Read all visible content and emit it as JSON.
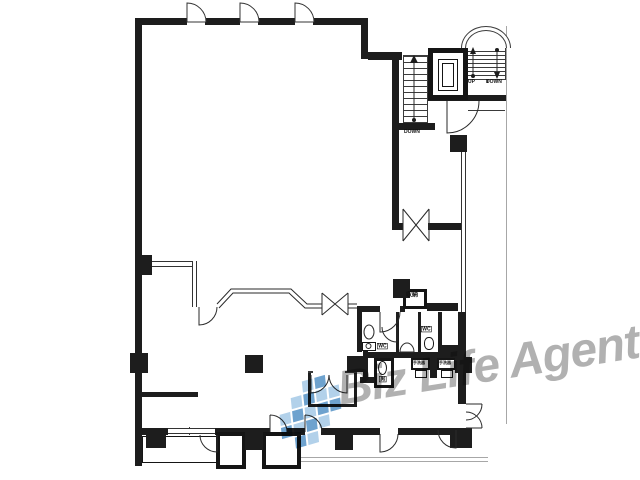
{
  "meta": {
    "background": "#ffffff",
    "wall_color": "#1d1d1d",
    "line_color": "#3a3a3a",
    "boundary_color": "#a7a7a7"
  },
  "watermark": {
    "text": "Biz Life Agent",
    "color": "#9b9b9b",
    "opacity": 0.78,
    "rotation_deg": -9,
    "font_px": 48,
    "x": 338,
    "y": 362,
    "logo": {
      "x": 279,
      "y": 380,
      "tile": 13,
      "rotation_deg": -16,
      "skew_deg": -10,
      "colors": [
        "",
        "#a5c9e6",
        "#5592c6"
      ],
      "grid": [
        [
          0,
          0,
          1,
          2,
          0
        ],
        [
          0,
          1,
          2,
          1,
          1
        ],
        [
          1,
          2,
          1,
          2,
          2
        ],
        [
          2,
          1,
          2,
          1,
          0
        ],
        [
          0,
          2,
          1,
          0,
          0
        ]
      ]
    }
  },
  "labels": [
    {
      "n": "stair-down-label",
      "t": "DOWN",
      "x": 404,
      "y": 129,
      "s": 5,
      "b": 0
    },
    {
      "n": "up-label",
      "t": "UP",
      "x": 468,
      "y": 79,
      "s": 5,
      "b": 0
    },
    {
      "n": "down-label",
      "t": "DOWN",
      "x": 486,
      "y": 79,
      "s": 5,
      "b": 0
    },
    {
      "n": "storage-label",
      "t": "収納",
      "x": 406,
      "y": 292,
      "s": 6,
      "b": 0
    },
    {
      "n": "wc-label-1",
      "t": "WC",
      "x": 421,
      "y": 326,
      "s": 5,
      "b": 1
    },
    {
      "n": "wc-label-2",
      "t": "WC",
      "x": 377,
      "y": 343,
      "s": 5,
      "b": 1
    },
    {
      "n": "urinal-label",
      "t": "男",
      "x": 379,
      "y": 376,
      "s": 5,
      "b": 1
    },
    {
      "n": "wash-counter-label-1",
      "t": "手洗器",
      "x": 413,
      "y": 361,
      "s": 4,
      "b": 0
    },
    {
      "n": "wash-counter-label-2",
      "t": "手洗器",
      "x": 439,
      "y": 361,
      "s": 4,
      "b": 0
    }
  ],
  "floorplan": {
    "walls": [
      [
        135,
        18,
        52,
        7
      ],
      [
        205,
        18,
        35,
        7
      ],
      [
        258,
        18,
        37,
        7
      ],
      [
        313,
        18,
        55,
        7
      ],
      [
        361,
        18,
        7,
        41
      ],
      [
        368,
        52,
        34,
        8
      ],
      [
        392,
        52,
        7,
        178
      ],
      [
        135,
        18,
        7,
        448
      ],
      [
        397,
        123,
        38,
        7
      ],
      [
        428,
        95,
        79,
        6
      ],
      [
        397,
        223,
        6,
        7
      ],
      [
        428,
        223,
        37,
        7
      ],
      [
        458,
        312,
        8,
        92
      ],
      [
        142,
        428,
        26,
        7
      ],
      [
        215,
        428,
        55,
        7
      ],
      [
        287,
        428,
        18,
        7
      ],
      [
        321,
        428,
        59,
        7
      ],
      [
        398,
        428,
        54,
        7
      ],
      [
        142,
        392,
        56,
        5
      ],
      [
        357,
        306,
        23,
        6
      ],
      [
        400,
        306,
        5,
        6
      ],
      [
        357,
        306,
        5,
        46
      ],
      [
        363,
        350,
        5,
        32
      ],
      [
        360,
        377,
        32,
        6
      ],
      [
        396,
        312,
        3,
        40
      ],
      [
        418,
        312,
        3,
        40
      ],
      [
        438,
        312,
        4,
        33
      ],
      [
        438,
        345,
        28,
        8
      ],
      [
        366,
        352,
        92,
        6
      ],
      [
        430,
        357,
        7,
        21
      ],
      [
        427,
        303,
        31,
        8
      ],
      [
        308,
        373,
        3,
        34
      ],
      [
        308,
        404,
        49,
        3
      ],
      [
        354,
        373,
        3,
        31
      ]
    ],
    "columns": [
      [
        135,
        255,
        17,
        20
      ],
      [
        130,
        353,
        18,
        20
      ],
      [
        245,
        355,
        18,
        18
      ],
      [
        393,
        279,
        17,
        19
      ],
      [
        450,
        135,
        17,
        17
      ],
      [
        347,
        356,
        19,
        16
      ],
      [
        455,
        357,
        17,
        16
      ],
      [
        146,
        430,
        20,
        18
      ],
      [
        245,
        430,
        18,
        20
      ],
      [
        335,
        431,
        18,
        19
      ],
      [
        450,
        428,
        22,
        20
      ]
    ],
    "thin_lines": [
      [
        468,
        110,
        37,
        1
      ],
      [
        487,
        45,
        1,
        38
      ],
      [
        189,
        427,
        1,
        8
      ],
      [
        308,
        371,
        5,
        2
      ],
      [
        345,
        371,
        12,
        2
      ]
    ],
    "gray_lines": [
      [
        506,
        26,
        1,
        398
      ],
      [
        300,
        457,
        188,
        1
      ],
      [
        300,
        461,
        188,
        1
      ]
    ],
    "windows": [
      {
        "x": 152,
        "y": 261,
        "w": 45,
        "h": 6,
        "o": "h"
      },
      {
        "x": 192,
        "y": 261,
        "w": 5,
        "h": 46,
        "o": "v"
      },
      {
        "x": 461,
        "y": 152,
        "w": 5,
        "h": 160,
        "o": "v"
      },
      {
        "x": 168,
        "y": 428,
        "w": 47,
        "h": 6,
        "o": "h"
      }
    ],
    "stairs": [
      {
        "n": "inner-stair-treads",
        "x": 403,
        "y": 55,
        "w": 25,
        "h": 68,
        "step": 6
      },
      {
        "n": "outer-stair-treads",
        "x": 466,
        "y": 46,
        "w": 40,
        "h": 34,
        "step": 4
      }
    ],
    "domes": [
      {
        "n": "outer-stair-arch",
        "x": 461,
        "y": 26,
        "w": 50,
        "h": 22
      },
      {
        "n": "outer-stair-arch-inner",
        "x": 465,
        "y": 30,
        "w": 42,
        "h": 18
      }
    ],
    "boxes": [
      {
        "n": "elevator-shaft",
        "x": 428,
        "y": 48,
        "w": 40,
        "h": 52,
        "bw": 5
      },
      {
        "n": "elevator-car",
        "x": 438,
        "y": 59,
        "w": 20,
        "h": 32,
        "bw": 1
      },
      {
        "n": "elevator-car-inner",
        "x": 442,
        "y": 63,
        "w": 12,
        "h": 24,
        "bw": 1
      },
      {
        "n": "storage-room",
        "x": 403,
        "y": 289,
        "w": 24,
        "h": 20,
        "bw": 3
      },
      {
        "n": "urinal-room",
        "x": 374,
        "y": 358,
        "w": 20,
        "h": 30,
        "bw": 3
      },
      {
        "n": "entrance-vestibule-a",
        "x": 216,
        "y": 432,
        "w": 30,
        "h": 37,
        "bw": 4
      },
      {
        "n": "entrance-vestibule-b",
        "x": 262,
        "y": 432,
        "w": 39,
        "h": 37,
        "bw": 4
      },
      {
        "n": "wash-counter-1",
        "x": 411,
        "y": 358,
        "w": 19,
        "h": 12,
        "bw": 2
      },
      {
        "n": "wash-counter-2",
        "x": 437,
        "y": 358,
        "w": 19,
        "h": 12,
        "bw": 2
      },
      {
        "n": "sink-1",
        "x": 415,
        "y": 370,
        "w": 12,
        "h": 8,
        "bw": 1
      },
      {
        "n": "sink-2",
        "x": 441,
        "y": 370,
        "w": 12,
        "h": 8,
        "bw": 1
      },
      {
        "n": "powder-sink",
        "x": 362,
        "y": 342,
        "w": 14,
        "h": 9,
        "bw": 1
      },
      {
        "n": "toilet",
        "x": 424,
        "y": 337,
        "w": 10,
        "h": 13,
        "bw": 1,
        "r": "45%"
      },
      {
        "n": "urinal",
        "x": 378,
        "y": 361,
        "w": 9,
        "h": 14,
        "bw": 1,
        "r": "50%"
      },
      {
        "n": "balcony-outline",
        "x": 142,
        "y": 436,
        "w": 75,
        "h": 27,
        "bw": 1
      }
    ],
    "paths": [
      {
        "n": "top-door-1",
        "d": "M187,22 L187,3 A19,19 0 0 1 206,22 Z",
        "k": "door"
      },
      {
        "n": "top-door-2",
        "d": "M240,22 L240,3 A19,19 0 0 1 259,22 Z",
        "k": "door"
      },
      {
        "n": "top-door-3",
        "d": "M295,22 L295,3 A19,19 0 0 1 314,22 Z",
        "k": "door"
      },
      {
        "n": "stair-hall-door",
        "d": "M447,101 L447,133 A32,32 0 0 0 479,101",
        "k": "s"
      },
      {
        "n": "double-swing-door-1",
        "d": "M403,209 L403,241 M429,209 L429,241 M403,209 Q416,225 429,241 M429,209 Q416,225 403,241",
        "k": "s"
      },
      {
        "n": "bay-partition-line-1",
        "d": "M217,304 L231,289 L291,289 L307,304 L322,304",
        "k": "s"
      },
      {
        "n": "bay-partition-line-2",
        "d": "M219,308 L233,293 L289,293 L305,308 L322,308",
        "k": "s"
      },
      {
        "n": "partition-link",
        "d": "M348,304 L357,304 M348,308 L357,308",
        "k": "s"
      },
      {
        "n": "double-swing-door-2",
        "d": "M322,293 L322,315 M348,293 L348,315 M322,293 Q335,304 348,315 M348,293 Q335,304 322,315",
        "k": "s"
      },
      {
        "n": "partition-door",
        "d": "M199,307 L199,325 A18,18 0 0 0 217,307",
        "k": "s"
      },
      {
        "n": "wc-entry-door",
        "d": "M380,312 L380,332 A20,20 0 0 0 400,312",
        "k": "s"
      },
      {
        "n": "mid-wc-door",
        "d": "M397,327 L397,342 A15,15 0 0 1 382,327",
        "k": "s"
      },
      {
        "n": "small-room-doors",
        "d": "M311,375 L311,393 A18,18 0 0 0 329,375 M347,375 L347,393 A18,18 0 0 1 329,375",
        "k": "s"
      },
      {
        "n": "vestibule-door",
        "d": "M217,435 L217,452 A17,17 0 0 1 200,435",
        "k": "s"
      },
      {
        "n": "bottom-door-1",
        "d": "M270,415 L270,432 M270,415 A17,17 0 0 1 287,432",
        "k": "s"
      },
      {
        "n": "bottom-door-2",
        "d": "M305,415 L305,432 M305,415 A17,17 0 0 1 322,432",
        "k": "s"
      },
      {
        "n": "bottom-door-3",
        "d": "M380,434 L380,452 A18,18 0 0 0 398,434",
        "k": "s"
      },
      {
        "n": "bottom-right-door",
        "d": "M456,430 L456,448 A18,18 0 0 1 438,430",
        "k": "s"
      },
      {
        "n": "right-double-door",
        "d": "M466,404 L482,404 M482,404 A16,16 0 0 1 466,420 M466,428 L482,428 M482,428 A16,16 0 0 0 466,412",
        "k": "s"
      },
      {
        "n": "inner-stair-arrow",
        "d": "M414,60 L414,120",
        "k": "s"
      },
      {
        "n": "inner-stair-arrowhead",
        "d": "M414,55 L410,63 L418,63 Z",
        "k": "f"
      },
      {
        "n": "inner-stair-dot",
        "d": "M412,120 a2,2 0 1 0 4,0 a2,2 0 1 0 -4,0",
        "k": "f"
      },
      {
        "n": "up-arrow",
        "d": "M473,52 L473,76",
        "k": "s"
      },
      {
        "n": "up-arrowhead",
        "d": "M473,47 L470,54 L476,54 Z",
        "k": "f"
      },
      {
        "n": "up-arrow-dot",
        "d": "M471,76 a2,2 0 1 0 4,0 a2,2 0 1 0 -4,0",
        "k": "f"
      },
      {
        "n": "down-arrow",
        "d": "M497,50 L497,74",
        "k": "s"
      },
      {
        "n": "down-arrowhead",
        "d": "M497,79 L494,72 L500,72 Z",
        "k": "f"
      },
      {
        "n": "down-arrow-dot",
        "d": "M495,50 a2,2 0 1 0 4,0 a2,2 0 1 0 -4,0",
        "k": "f"
      },
      {
        "n": "powder-basin",
        "d": "M364,332 a5,7 0 1 0 10,0 a5,7 0 1 0 -10,0",
        "k": "s"
      },
      {
        "n": "powder-sink-bowl",
        "d": "M366,346 a2.5,2.5 0 1 0 5,0 a2.5,2.5 0 1 0 -5,0",
        "k": "s"
      },
      {
        "n": "mid-wc-basin",
        "d": "M400,352 A7,9 0 0 1 414,352 L400,352 Z",
        "k": "s"
      }
    ]
  }
}
